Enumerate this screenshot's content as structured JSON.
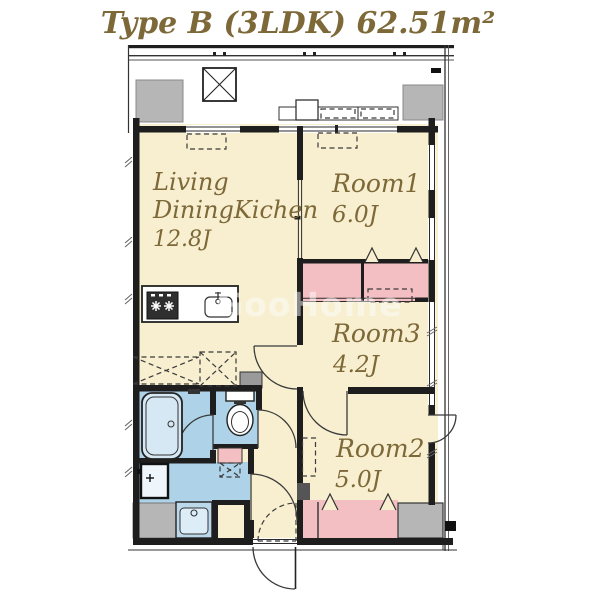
{
  "title": "Type B (3LDK) 62.51m²",
  "watermark": "GooHome",
  "rooms": {
    "ldk": {
      "line1": "Living",
      "line2": "DiningKichen",
      "size": "12.8J"
    },
    "room1": {
      "name": "Room1",
      "size": "6.0J"
    },
    "room3": {
      "name": "Room3",
      "size": "4.2J"
    },
    "room2": {
      "name": "Room2",
      "size": "5.0J"
    }
  },
  "palette": {
    "wall": "#1e1e1e",
    "room-cream": "#f7efd0",
    "closet-pink": "#f4bfc3",
    "wet-blue": "#aed3e8",
    "tub-fill": "#d6e8f4",
    "block-gray": "#b6b6b6",
    "dark-gray": "#555555",
    "label-gold": "#7d6838",
    "line": "#2a2a2a"
  },
  "icons": {
    "bathtub": "nested-rounded-rect",
    "toilet": "tank-and-ellipse",
    "washbasin": "circle-in-rect",
    "washing-machine": "thick-border-square",
    "stove": "star-burners",
    "kitchen-sink": "rounded-rect-with-faucet",
    "refrigerator-space": "dashed-x-square",
    "air-conditioner": "dashed-rect",
    "balcony-drain-pan": "x-square",
    "hanger-pipe": "chevron",
    "door-swing": "quarter-arc",
    "sliding-door": "double-thin-line",
    "window": "double-thin-line",
    "balcony-railing": "double-line"
  }
}
